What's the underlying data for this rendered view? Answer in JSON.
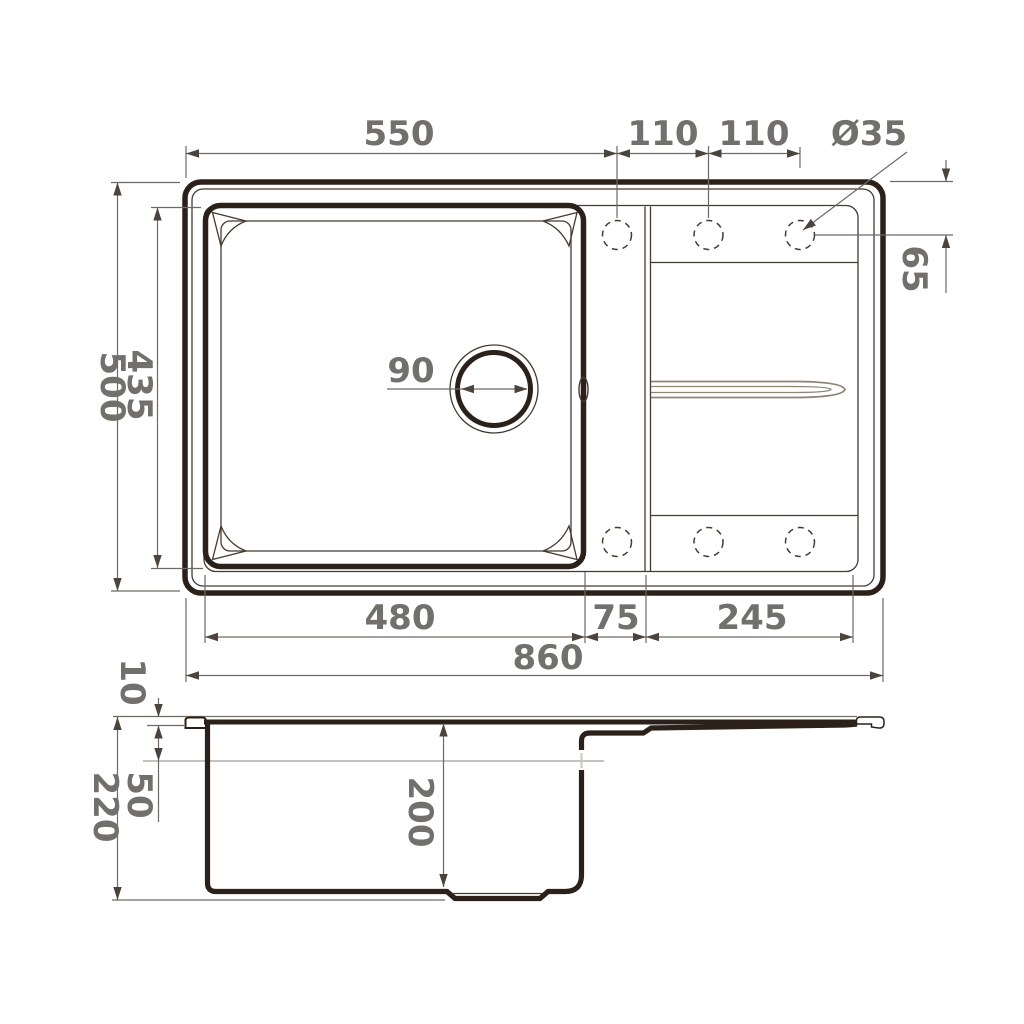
{
  "drawing": {
    "type": "technical-drawing",
    "subject": "kitchen sink with drainboard - top and side orthographic views with dimensions",
    "colors": {
      "outline": "#2b211a",
      "thin_line": "#453a2f",
      "dimension_line": "#6e6963",
      "dimension_text": "#72706c",
      "groove_line": "#8c8379",
      "background": "#ffffff"
    },
    "top_view": {
      "dimensions": {
        "left_edge_to_hole1": "550",
        "hole1_to_hole2": "110",
        "hole2_to_hole3": "110",
        "tap_hole_diameter": "Ø35",
        "hole_center_offset": "65",
        "overall_depth": "500",
        "bowl_opening_depth": "435",
        "drain_diameter": "90",
        "bowl_opening_width": "480",
        "divider_strip_width": "75",
        "drainboard_width": "245",
        "overall_width": "860"
      },
      "features": {
        "tap_holes_top_row": 3,
        "tap_holes_bottom_row": 3,
        "drain_holes": 1,
        "overflow_slots": 1
      }
    },
    "side_view": {
      "dimensions": {
        "rim_height": "10",
        "overflow_offset": "50",
        "overall_height": "220",
        "bowl_depth": "200"
      }
    }
  }
}
